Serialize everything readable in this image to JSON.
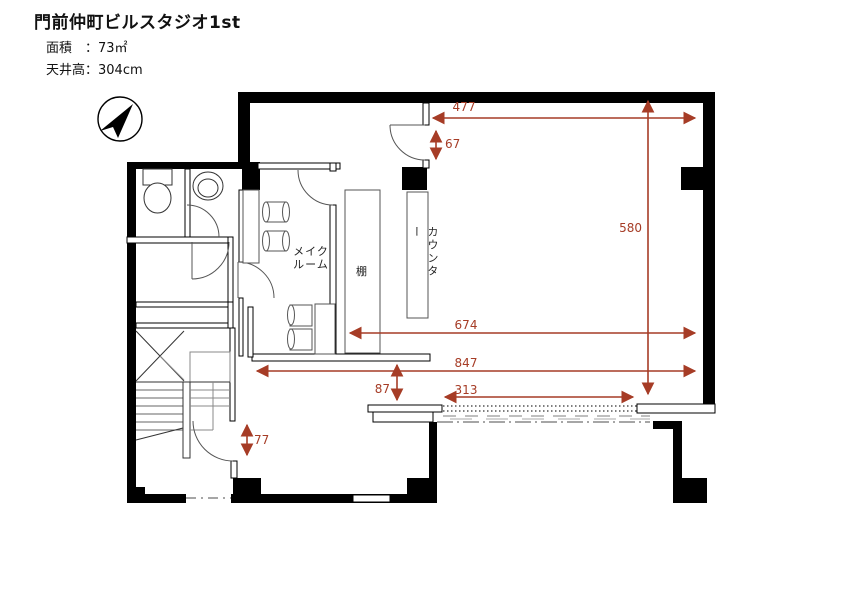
{
  "header": {
    "title": "門前仲町ビルスタジオ1st",
    "area_line": "面積　：73㎡",
    "ceiling_line": "天井高：304cm"
  },
  "labels": {
    "makeup_room_line1": "メイク",
    "makeup_room_line2": "ルーム",
    "shelf": "棚",
    "counter": "カウンター"
  },
  "dimensions": {
    "top_width": "477",
    "top_door": "67",
    "right_height": "580",
    "middle_width": "674",
    "full_width": "847",
    "passage_gap": "87",
    "sliding_opening": "313",
    "stair_door": "77"
  },
  "colors": {
    "dimension_accent": "#a63c26",
    "wall": "#000000"
  },
  "icons": {
    "compass": "north-arrow-icon"
  }
}
